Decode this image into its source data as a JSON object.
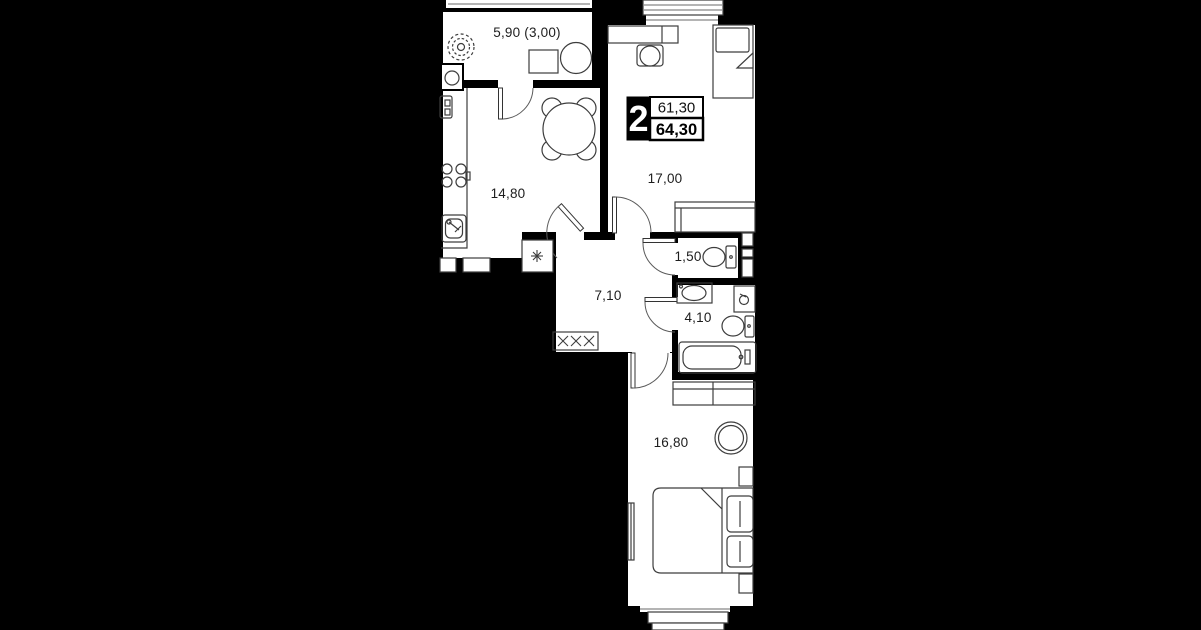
{
  "plan": {
    "badge": {
      "rooms_count": "2",
      "area_top": "61,30",
      "area_bottom": "64,30"
    },
    "rooms": [
      {
        "name": "balcony",
        "area_label": "5,90 (3,00)"
      },
      {
        "name": "kitchen",
        "area_label": "14,80"
      },
      {
        "name": "living-room",
        "area_label": "17,00"
      },
      {
        "name": "wc",
        "area_label": "1,50"
      },
      {
        "name": "bathroom",
        "area_label": "4,10"
      },
      {
        "name": "hallway",
        "area_label": "7,10"
      },
      {
        "name": "bedroom",
        "area_label": "16,80"
      }
    ],
    "furniture_icons": [
      "plant-icon",
      "washing-machine-icon",
      "balcony-table-icon",
      "balcony-chair-icon",
      "fridge-icon",
      "stove-icon",
      "kitchen-sink-icon",
      "dining-table-icon",
      "dining-chair-icon",
      "appliance-asterisk-icon",
      "desk-icon",
      "office-chair-icon",
      "single-bed-icon",
      "sofa-icon",
      "toilet-icon",
      "bathroom-sink-icon",
      "water-heater-icon",
      "bathtub-icon",
      "wardrobe-icon",
      "dresser-icon",
      "pouf-icon",
      "double-bed-icon",
      "pillow-icon",
      "nightstand-icon",
      "tv-icon"
    ],
    "colors": {
      "background": "#000000",
      "room_fill": "#ffffff",
      "furniture_line": "#3d3d3d",
      "label_text": "#1d1d1d",
      "badge_bg": "#000000",
      "badge_text": "#ffffff"
    }
  }
}
